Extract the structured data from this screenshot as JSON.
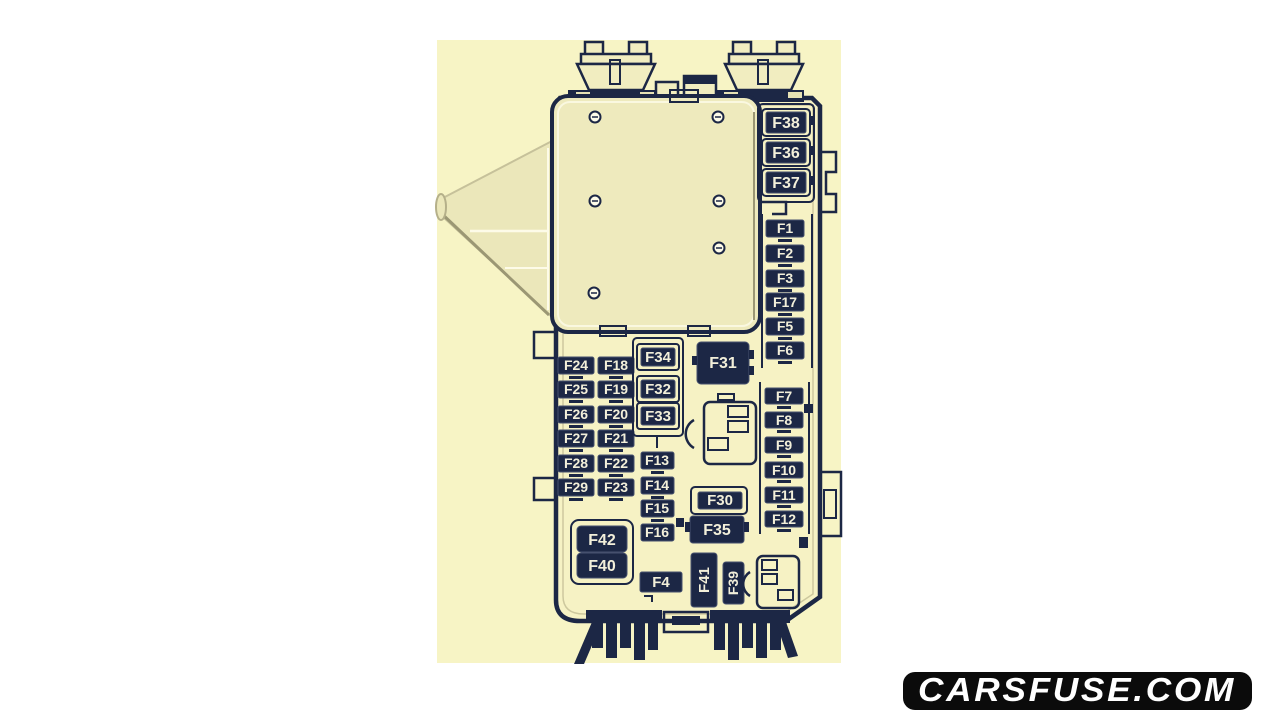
{
  "watermark": {
    "text": "CARSFUSE.COM",
    "bg": "#0b0b0b",
    "fg": "#ffffff"
  },
  "diagram": {
    "type": "vehicle-fuse-box-layout",
    "palette": {
      "paper": "#f7f4c5",
      "ink": "#1c2745",
      "fuse_fill": "#1c2745",
      "label_text": "#f2efda",
      "cover_plastic": "#eeeabd"
    },
    "groups": {
      "top_right_midi_fuses": [
        "F38",
        "F36",
        "F37"
      ],
      "right_column_upper": [
        "F1",
        "F2",
        "F3",
        "F17",
        "F5",
        "F6"
      ],
      "right_column_lower": [
        "F7",
        "F8",
        "F9",
        "F10",
        "F11",
        "F12"
      ],
      "left_grid_rows": [
        [
          "F24",
          "F18"
        ],
        [
          "F25",
          "F19"
        ],
        [
          "F26",
          "F20"
        ],
        [
          "F27",
          "F21"
        ],
        [
          "F28",
          "F22"
        ],
        [
          "F29",
          "F23"
        ]
      ],
      "middle_column": [
        "F34",
        "F32",
        "F33",
        "F13",
        "F14",
        "F15",
        "F16",
        "F4"
      ],
      "relays_and_large": [
        "F31",
        "F30",
        "F35",
        "F42",
        "F40",
        "F41",
        "F39"
      ]
    },
    "labels": {
      "f1": "F1",
      "f2": "F2",
      "f3": "F3",
      "f4": "F4",
      "f5": "F5",
      "f6": "F6",
      "f7": "F7",
      "f8": "F8",
      "f9": "F9",
      "f10": "F10",
      "f11": "F11",
      "f12": "F12",
      "f13": "F13",
      "f14": "F14",
      "f15": "F15",
      "f16": "F16",
      "f17": "F17",
      "f18": "F18",
      "f19": "F19",
      "f20": "F20",
      "f21": "F21",
      "f22": "F22",
      "f23": "F23",
      "f24": "F24",
      "f25": "F25",
      "f26": "F26",
      "f27": "F27",
      "f28": "F28",
      "f29": "F29",
      "f30": "F30",
      "f31": "F31",
      "f32": "F32",
      "f33": "F33",
      "f34": "F34",
      "f35": "F35",
      "f36": "F36",
      "f37": "F37",
      "f38": "F38",
      "f39": "F39",
      "f40": "F40",
      "f41": "F41",
      "f42": "F42"
    }
  }
}
